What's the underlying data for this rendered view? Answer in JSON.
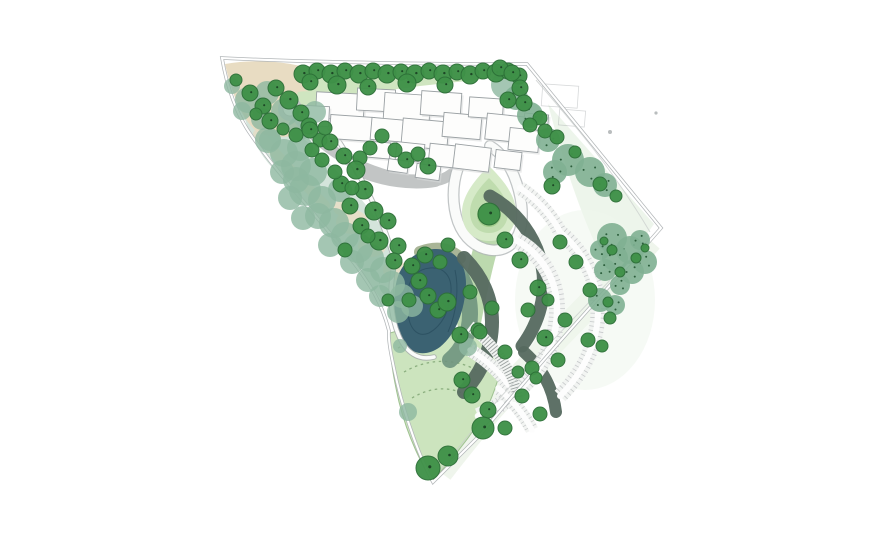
{
  "palette": {
    "boundary": "#b2b6b8",
    "boundary_inner": "#c9cdcc",
    "road": "#c2c5c5",
    "stall": "#c6c9ca",
    "path_casing": "#a8adad",
    "path_fill": "#fafbfa",
    "building_fill": "#fdfdfc",
    "building_stroke": "#9aa0a3",
    "building_shadow": "#d8dbda",
    "tan": "#e8dcc2",
    "strip_green": "#cfe5c0",
    "lawn": "#cbe4bc",
    "lawn_border": "#9cc08e",
    "corridor": "#bcd9ae",
    "pale": "#e9f2e6",
    "pond": "#3b6272",
    "pond_contour": "#2c5060",
    "shore": "#6f937e",
    "olive": "#9aa885",
    "hedge": "#55695f",
    "island_outer": "#d6eac8",
    "island_mid": "#bfdcae",
    "island_inner": "#a2cc8c",
    "tree": "#3f9148",
    "tree_edge": "#2d7038",
    "tree_dot": "#1d4726",
    "sage": "#8db8a0",
    "shrub": "#7fb092",
    "shrub_dot": "#2c5e3c",
    "dash_arc": "#84a878",
    "step_tick": "#9aa09f"
  },
  "features": [
    "site-boundary",
    "woodland-belt",
    "street-tree-row",
    "arrival-plaza",
    "building-complex",
    "entrance-road",
    "turning-circle",
    "drop-off-island",
    "pond",
    "wetland-margin",
    "car-park",
    "hedge-bands",
    "parking-stalls",
    "event-lawn",
    "mown-path-arcs",
    "shrub-planting",
    "stepped-path"
  ],
  "trees": {
    "dark": [
      [
        236,
        80,
        6
      ],
      [
        303,
        74,
        9
      ],
      [
        317,
        71,
        8
      ],
      [
        331,
        74,
        9
      ],
      [
        345,
        71,
        8
      ],
      [
        359,
        74,
        9
      ],
      [
        373,
        71,
        8
      ],
      [
        387,
        74,
        9
      ],
      [
        401,
        72,
        8
      ],
      [
        415,
        74,
        9
      ],
      [
        429,
        71,
        8
      ],
      [
        443,
        74,
        9
      ],
      [
        457,
        72,
        8
      ],
      [
        470,
        75,
        9
      ],
      [
        483,
        71,
        8
      ],
      [
        496,
        73,
        9
      ],
      [
        508,
        71,
        8
      ],
      [
        519,
        76,
        8
      ],
      [
        250,
        93,
        8
      ],
      [
        263,
        106,
        8
      ],
      [
        276,
        88,
        8
      ],
      [
        289,
        100,
        9
      ],
      [
        301,
        113,
        8
      ],
      [
        270,
        121,
        8
      ],
      [
        256,
        114,
        6
      ],
      [
        309,
        126,
        8
      ],
      [
        296,
        135,
        7
      ],
      [
        283,
        129,
        6
      ],
      [
        320,
        140,
        7
      ],
      [
        310,
        82,
        8
      ],
      [
        337,
        85,
        9
      ],
      [
        368,
        87,
        8
      ],
      [
        407,
        83,
        9
      ],
      [
        445,
        85,
        8
      ],
      [
        395,
        150,
        7
      ],
      [
        406,
        160,
        8
      ],
      [
        418,
        154,
        7
      ],
      [
        428,
        166,
        8
      ],
      [
        382,
        136,
        7
      ],
      [
        370,
        148,
        7
      ],
      [
        360,
        158,
        7
      ],
      [
        330,
        142,
        8
      ],
      [
        344,
        156,
        8
      ],
      [
        356,
        170,
        9
      ],
      [
        341,
        184,
        8
      ],
      [
        364,
        190,
        9
      ],
      [
        350,
        206,
        8
      ],
      [
        374,
        211,
        9
      ],
      [
        388,
        221,
        8
      ],
      [
        361,
        226,
        8
      ],
      [
        379,
        241,
        9
      ],
      [
        398,
        246,
        8
      ],
      [
        394,
        261,
        8
      ],
      [
        412,
        266,
        8
      ],
      [
        419,
        281,
        8
      ],
      [
        428,
        296,
        8
      ],
      [
        409,
        300,
        7
      ],
      [
        438,
        310,
        8
      ],
      [
        322,
        160,
        7
      ],
      [
        312,
        150,
        7
      ],
      [
        335,
        172,
        7
      ],
      [
        310,
        130,
        8
      ],
      [
        325,
        128,
        7
      ],
      [
        352,
        188,
        7
      ],
      [
        368,
        236,
        7
      ],
      [
        345,
        250,
        7
      ],
      [
        388,
        300,
        6
      ],
      [
        425,
        255,
        8
      ],
      [
        440,
        262,
        7
      ],
      [
        448,
        245,
        7
      ],
      [
        447,
        302,
        9
      ],
      [
        470,
        292,
        7
      ],
      [
        460,
        335,
        8
      ],
      [
        478,
        330,
        7
      ],
      [
        489,
        214,
        11
      ],
      [
        500,
        68,
        8
      ],
      [
        512,
        73,
        8
      ],
      [
        520,
        88,
        8
      ],
      [
        508,
        100,
        8
      ],
      [
        524,
        103,
        8
      ],
      [
        540,
        118,
        7
      ],
      [
        530,
        125,
        7
      ],
      [
        545,
        131,
        7
      ],
      [
        557,
        137,
        7
      ],
      [
        552,
        186,
        8
      ],
      [
        600,
        184,
        7
      ],
      [
        575,
        152,
        6
      ],
      [
        616,
        196,
        6
      ],
      [
        612,
        250,
        5
      ],
      [
        636,
        258,
        5
      ],
      [
        620,
        272,
        5
      ],
      [
        604,
        241,
        4
      ],
      [
        645,
        248,
        4
      ],
      [
        608,
        302,
        5
      ],
      [
        505,
        240,
        8
      ],
      [
        520,
        260,
        8
      ],
      [
        538,
        288,
        8
      ],
      [
        528,
        310,
        7
      ],
      [
        545,
        338,
        8
      ],
      [
        558,
        360,
        7
      ],
      [
        532,
        368,
        7
      ],
      [
        505,
        352,
        7
      ],
      [
        480,
        332,
        7
      ],
      [
        492,
        308,
        7
      ],
      [
        560,
        242,
        7
      ],
      [
        576,
        262,
        7
      ],
      [
        590,
        290,
        7
      ],
      [
        565,
        320,
        7
      ],
      [
        588,
        340,
        7
      ],
      [
        548,
        300,
        6
      ],
      [
        610,
        318,
        6
      ],
      [
        602,
        346,
        6
      ],
      [
        462,
        380,
        8
      ],
      [
        472,
        395,
        8
      ],
      [
        488,
        410,
        8
      ],
      [
        522,
        396,
        7
      ],
      [
        540,
        414,
        7
      ],
      [
        505,
        428,
        7
      ],
      [
        483,
        428,
        11
      ],
      [
        448,
        456,
        10
      ],
      [
        428,
        468,
        12
      ],
      [
        536,
        378,
        6
      ],
      [
        518,
        372,
        6
      ]
    ],
    "sage": [
      [
        232,
        86,
        8
      ],
      [
        248,
        100,
        13
      ],
      [
        267,
        93,
        12
      ],
      [
        285,
        112,
        14
      ],
      [
        262,
        119,
        11
      ],
      [
        242,
        111,
        9
      ],
      [
        300,
        128,
        12
      ],
      [
        315,
        112,
        11
      ],
      [
        268,
        140,
        13
      ],
      [
        284,
        153,
        14
      ],
      [
        300,
        148,
        13
      ],
      [
        296,
        166,
        15
      ],
      [
        313,
        172,
        14
      ],
      [
        282,
        172,
        12
      ],
      [
        305,
        190,
        16
      ],
      [
        322,
        200,
        14
      ],
      [
        290,
        198,
        12
      ],
      [
        318,
        216,
        13
      ],
      [
        334,
        223,
        15
      ],
      [
        303,
        218,
        12
      ],
      [
        345,
        236,
        14
      ],
      [
        358,
        248,
        15
      ],
      [
        330,
        245,
        12
      ],
      [
        370,
        258,
        14
      ],
      [
        383,
        270,
        13
      ],
      [
        352,
        262,
        12
      ],
      [
        392,
        284,
        13
      ],
      [
        402,
        296,
        12
      ],
      [
        368,
        280,
        12
      ],
      [
        398,
        312,
        11
      ],
      [
        380,
        296,
        11
      ],
      [
        412,
        306,
        11
      ],
      [
        296,
        180,
        13
      ],
      [
        340,
        190,
        12
      ],
      [
        270,
        140,
        11
      ],
      [
        505,
        85,
        14
      ],
      [
        400,
        346,
        7
      ],
      [
        408,
        412,
        9
      ],
      [
        468,
        347,
        9
      ]
    ],
    "speckled": [
      [
        568,
        160,
        16
      ],
      [
        590,
        172,
        15
      ],
      [
        555,
        172,
        12
      ],
      [
        605,
        185,
        12
      ],
      [
        612,
        238,
        15
      ],
      [
        630,
        250,
        14
      ],
      [
        645,
        262,
        12
      ],
      [
        615,
        258,
        13
      ],
      [
        632,
        272,
        12
      ],
      [
        605,
        270,
        11
      ],
      [
        620,
        285,
        10
      ],
      [
        640,
        240,
        10
      ],
      [
        600,
        250,
        10
      ],
      [
        600,
        300,
        12
      ],
      [
        615,
        305,
        10
      ],
      [
        516,
        98,
        12
      ],
      [
        530,
        115,
        13
      ],
      [
        548,
        140,
        12
      ]
    ]
  },
  "buildings": {
    "main": [
      [
        340,
        106,
        48,
        26,
        3
      ],
      [
        376,
        100,
        38,
        22,
        3
      ],
      [
        407,
        108,
        46,
        28,
        4
      ],
      [
        441,
        104,
        40,
        24,
        4
      ],
      [
        316,
        116,
        26,
        20,
        3
      ],
      [
        352,
        128,
        44,
        24,
        4
      ],
      [
        390,
        130,
        38,
        22,
        5
      ],
      [
        425,
        134,
        46,
        28,
        5
      ],
      [
        462,
        126,
        38,
        24,
        5
      ],
      [
        486,
        108,
        34,
        20,
        4
      ],
      [
        505,
        128,
        38,
        26,
        6
      ],
      [
        524,
        140,
        30,
        22,
        6
      ],
      [
        446,
        156,
        34,
        22,
        6
      ],
      [
        410,
        152,
        28,
        18,
        6
      ],
      [
        472,
        158,
        36,
        24,
        7
      ],
      [
        508,
        160,
        26,
        18,
        7
      ],
      [
        536,
        122,
        24,
        16,
        5
      ],
      [
        378,
        150,
        24,
        16,
        5
      ],
      [
        398,
        166,
        20,
        12,
        8
      ],
      [
        428,
        172,
        24,
        14,
        8
      ]
    ],
    "faint": [
      [
        560,
        96,
        36,
        22,
        4
      ],
      [
        572,
        118,
        26,
        16,
        5
      ]
    ]
  },
  "specks": [
    [
      610,
      132,
      2
    ],
    [
      656,
      113,
      1.6
    ]
  ]
}
